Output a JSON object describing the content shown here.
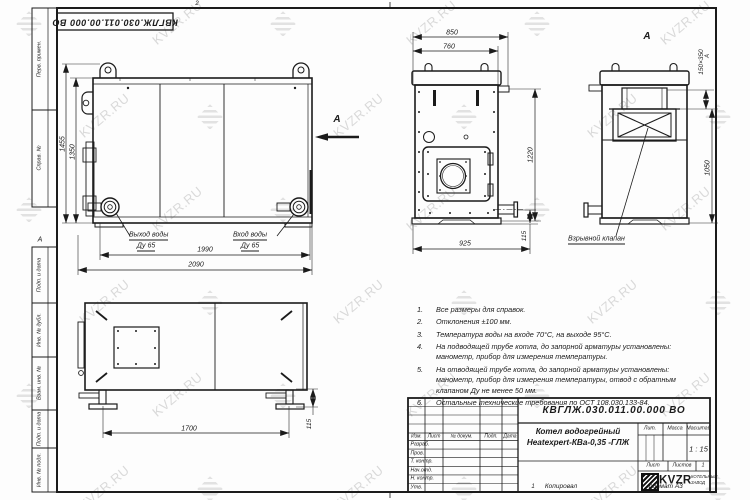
{
  "page": {
    "doc_number": "КВГЛЖ.030.011.00.000 ВО",
    "fold_top": "2",
    "fold_bottom": "1",
    "fold_left": "А",
    "fold_right": "А"
  },
  "watermark": {
    "text": "KVZR.RU"
  },
  "margin": {
    "perv": "Перв. примен.",
    "sprav": "Справ. №",
    "podp1": "Подп. и дата",
    "inv_dubl": "Инв. № дубл.",
    "vzam": "Взам. инв. №",
    "podp2": "Подп. и дата",
    "inv_podl": "Инв. № подл."
  },
  "front": {
    "dim_1455": "1455",
    "dim_1350": "1350",
    "dim_1990": "1990",
    "dim_2090": "2090",
    "outlet_label": "Выход воды",
    "outlet_dn": "Ду 65",
    "inlet_label": "Вход воды",
    "inlet_dn": "Ду 65",
    "arrow_label": "А"
  },
  "top": {
    "dim_850": "850",
    "dim_760": "760",
    "dim_1220": "1220",
    "dim_925": "925",
    "dim_115": "115"
  },
  "rear": {
    "view_title": "А",
    "dim_vent": "150×350",
    "dim_1050": "1050",
    "valve_label": "Взрывной клапан"
  },
  "side": {
    "dim_1700": "1700",
    "dim_115": "115"
  },
  "notes": [
    {
      "num": "1.",
      "lines": [
        "Все размеры для справок."
      ]
    },
    {
      "num": "2.",
      "lines": [
        "Отклонения ±100 мм."
      ]
    },
    {
      "num": "3.",
      "lines": [
        "Температура воды на входе 70°С, на выходе 95°С."
      ]
    },
    {
      "num": "4.",
      "lines": [
        "На подводящей трубе котла, до запорной арматуры установлены:",
        "манометр, прибор для измерения температуры."
      ]
    },
    {
      "num": "5.",
      "lines": [
        "На отводящей трубе котла, до запорной арматуры установлены:",
        "манометр, прибор для измерения температуры, отвод с обратным",
        "клапаном Ду не менее 50 мм."
      ]
    },
    {
      "num": "6.",
      "lines": [
        "Остальные технические требования по ОСТ 108.030.133-84."
      ]
    }
  ],
  "title_block": {
    "doc_number": "КВГЛЖ.030.011.00.000 ВО",
    "product_name_1": "Котел водогрейный",
    "product_name_2": "Heatexpert-КВа-0,35 -ГЛЖ",
    "col_izm": "Изм.",
    "col_list": "Лист",
    "col_doc": "№ докум.",
    "col_podp": "Подп.",
    "col_data": "Дата",
    "rows": [
      "Разраб.",
      "Пров.",
      "Т. контр.",
      "Нач.отд.",
      "Н. контр.",
      "Утв."
    ],
    "lit": "Лит.",
    "mass": "Масса",
    "scale_label": "Масштаб",
    "scale_value": "1 : 15",
    "sheet_label": "Лист",
    "sheets_label": "Листов",
    "sheets_value": "1",
    "brand": "KVZR",
    "brand_sub1": "КОТЕЛЬНЫЙ",
    "brand_sub2": "ЗАВОД"
  },
  "footer": {
    "copy": "Копировал",
    "format": "Формат А3"
  }
}
